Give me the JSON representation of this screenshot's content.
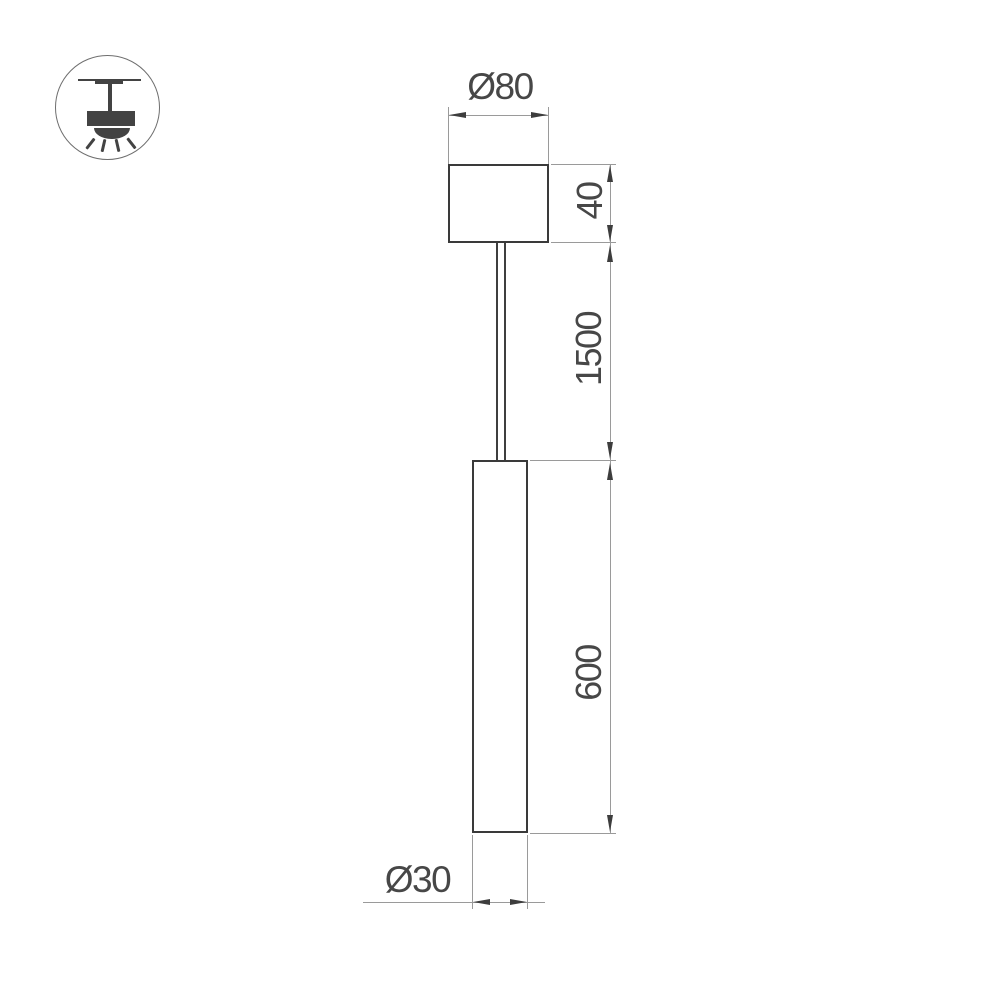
{
  "drawing": {
    "type": "pendant-luminaire-dimension-drawing",
    "labels": {
      "canopy_diameter": "Ø80",
      "canopy_height": "40",
      "suspension_length": "1500",
      "tube_length": "600",
      "tube_diameter": "Ø30"
    },
    "colors": {
      "background": "#ffffff",
      "object_outline": "#3a3a3a",
      "dimension_line": "#9a9a9a",
      "arrowhead": "#3d3d3d",
      "dimension_text": "#474747",
      "icon_fill": "#434343",
      "icon_circle_stroke": "#6e6e6e"
    },
    "icon": {
      "name": "ceiling-pendant-mount-icon",
      "description": "circled pictogram of a surface-mounted pendant spotlight shining downward"
    }
  }
}
